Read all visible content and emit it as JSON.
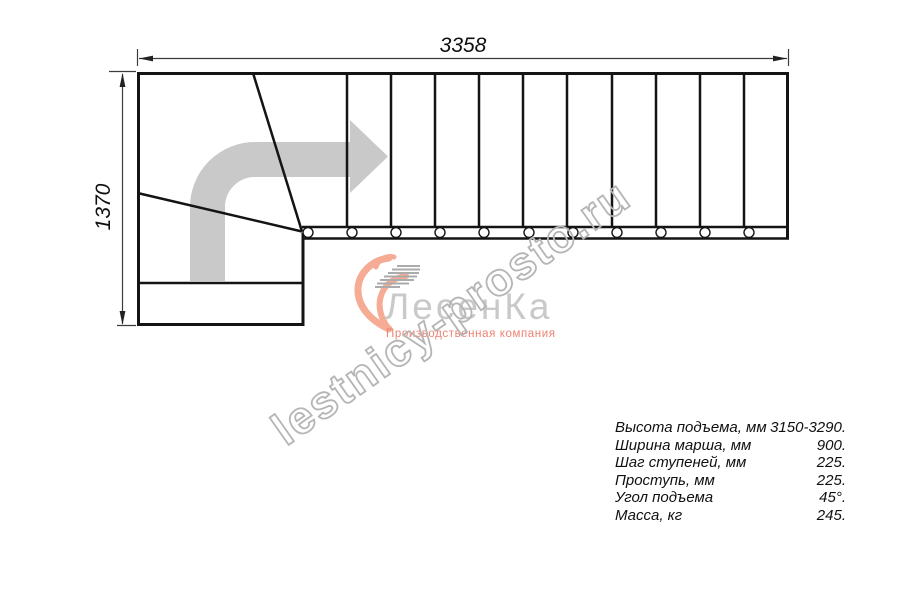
{
  "drawing": {
    "width_label": "3358",
    "height_label": "1370",
    "stair": {
      "straight_treads": 11,
      "winder_treads": 3,
      "balusters": 11,
      "turn_direction": "up-then-right"
    },
    "colors": {
      "line": "#141414",
      "dimension": "#3c3c3c",
      "direction_arrow": "#c9c9c9"
    }
  },
  "watermark": {
    "text": "lestnicy-prosto.ru",
    "color": "#b5b5b5"
  },
  "logo": {
    "name": "ЛесенКа",
    "tagline": "Производственная компания",
    "name_color": "#c9c9c9",
    "accent_color": "#f6ab94",
    "stairs_icon_color": "#ababab"
  },
  "specs": {
    "rows": [
      {
        "label": "Высота подъема, мм",
        "value": "3150-3290."
      },
      {
        "label": "Ширина марша, мм",
        "value": "900."
      },
      {
        "label": "Шаг ступеней, мм",
        "value": "225."
      },
      {
        "label": "Проступь, мм",
        "value": "225."
      },
      {
        "label": "Угол подъема",
        "value": "45°."
      },
      {
        "label": "Масса, кг",
        "value": "245."
      }
    ]
  }
}
